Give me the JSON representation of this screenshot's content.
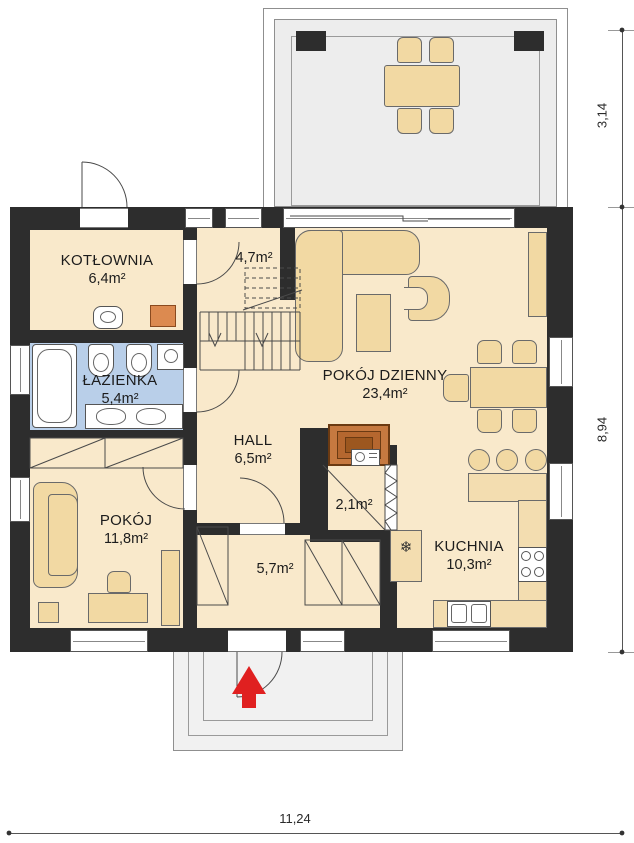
{
  "plan": {
    "rooms": {
      "kotlownia": {
        "name": "KOTŁOWNIA",
        "area": "6,4m²"
      },
      "schody": {
        "area": "4,7m²"
      },
      "lazienka": {
        "name": "ŁAZIENKA",
        "area": "5,4m²"
      },
      "hall": {
        "name": "HALL",
        "area": "6,5m²"
      },
      "pokoj": {
        "name": "POKÓJ",
        "area": "11,8m²"
      },
      "wiatrolap": {
        "area": "5,7m²"
      },
      "spizarnia": {
        "area": "2,1m²"
      },
      "pokoj_dzienny": {
        "name": "POKÓJ DZIENNY",
        "area": "23,4m²"
      },
      "kuchnia": {
        "name": "KUCHNIA",
        "area": "10,3m²"
      }
    },
    "dimensions": {
      "terrace_depth": "3,14",
      "house_depth": "8,94",
      "house_width": "11,24"
    },
    "symbols": {
      "fridge": "❄"
    },
    "colors": {
      "wall": "#2d2d2d",
      "floor": "#f9e9cb",
      "furniture": "#f2d9a3",
      "bathroom_floor": "#b9cfe9",
      "boiler": "#dc8a50",
      "fireplace": "#c67940",
      "terrace": "#ededed",
      "entrance_arrow": "#e02020"
    }
  }
}
